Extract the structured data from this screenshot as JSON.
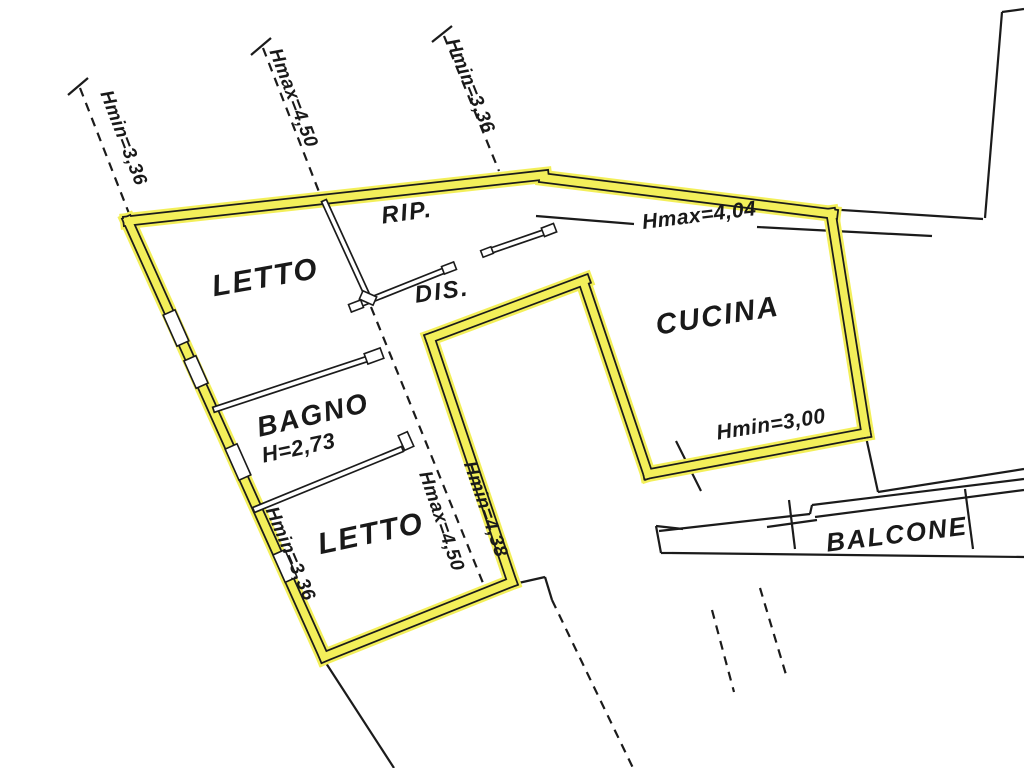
{
  "plan": {
    "background_color": "#ffffff",
    "highlight_color": "#f3ef5a",
    "line_color": "#1b1b1b",
    "rooms": {
      "letto1": {
        "label": "LETTO"
      },
      "rip": {
        "label": "RIP."
      },
      "dis": {
        "label": "DIS."
      },
      "cucina": {
        "label": "CUCINA"
      },
      "bagno": {
        "label": "BAGNO",
        "height": "H=2,73"
      },
      "letto2": {
        "label": "LETTO"
      },
      "balcone": {
        "label": "BALCONE"
      }
    },
    "annotations": {
      "hmin_top_left": "Hmin=3,36",
      "hmax_top": "Hmax=4,50",
      "hmin_top_mid": "Hmin=3,36",
      "hmax_kitchen": "Hmax=4,04",
      "hmin_kitchen": "Hmin=3,00",
      "hmax_mid": "Hmax=4,50",
      "hmin_mid": "Hmin=4,38",
      "hmin_bottom_left": "Hmin=3,36"
    }
  }
}
